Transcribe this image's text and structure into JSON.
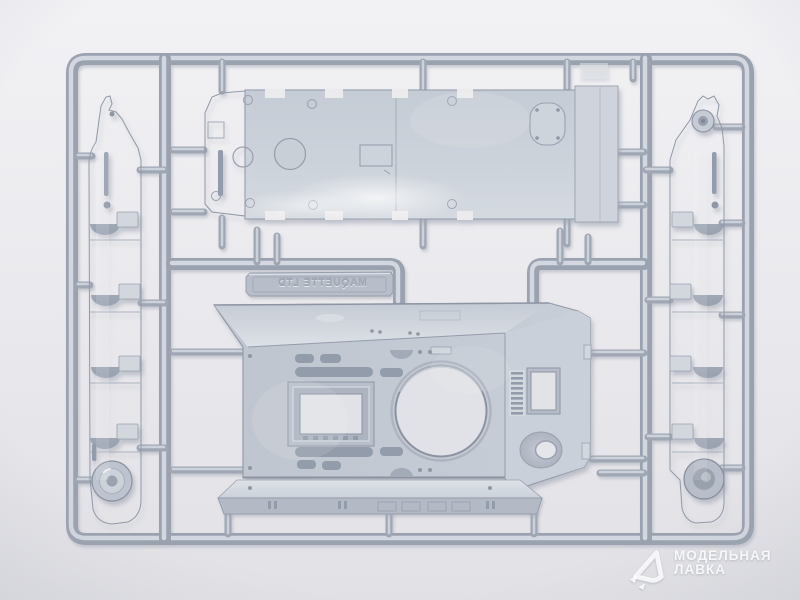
{
  "scene": {
    "embossed_text": "MAQUETTE LTD",
    "embossed_text_mirrored": true,
    "subject": "grey plastic model kit sprue with tank hull parts on light backdrop"
  },
  "watermark": {
    "line1": "МОДЕЛЬНАЯ",
    "line2": "ЛАВКА",
    "logo_icon": "modelnaya-lavka-triangle-logo"
  },
  "colors": {
    "background_top": "#f2f2f5",
    "background_bottom": "#e2e2e6",
    "plastic_base": "#c4cad3",
    "plastic_light": "#d6dbe2",
    "plastic_dark": "#8e95a3",
    "runner_core": "#d3d8e0",
    "runner_edge": "#9aa1af",
    "watermark_text": "#ffffff"
  }
}
